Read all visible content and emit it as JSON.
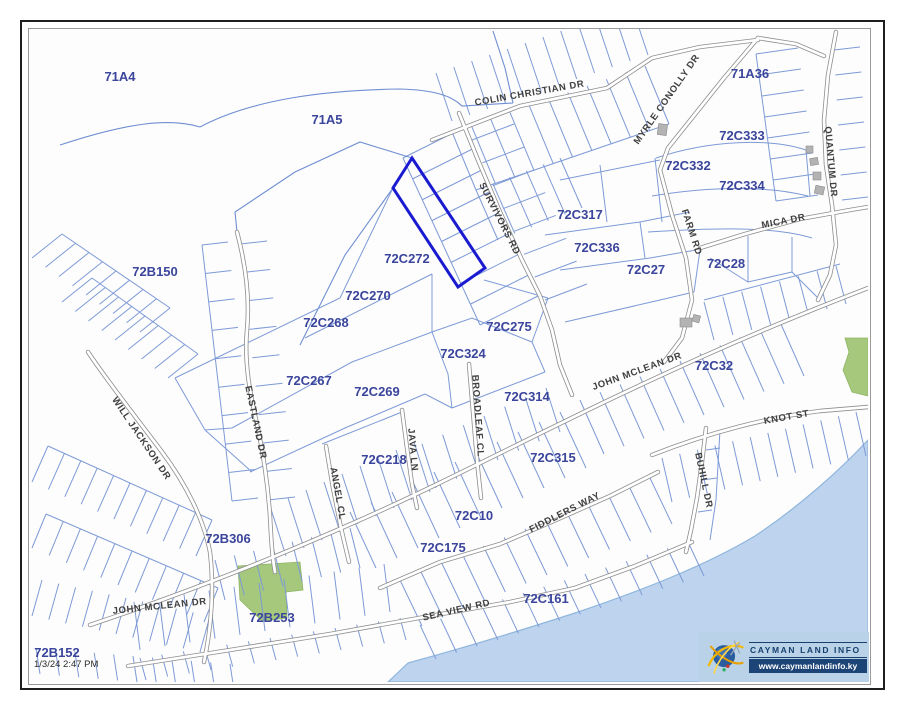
{
  "branding": {
    "name": "CAYMAN LAND INFO",
    "url": "www.caymanlandinfo.ky"
  },
  "status": {
    "timestamp": "1/3/24 2:47 PM"
  },
  "highlight": {
    "parcel_id": "72C272",
    "outline_color": "#1a1ad1"
  },
  "colors": {
    "parcel_line": "#7d9ad6",
    "road_casing": "#8d8d8d",
    "road_fill": "#ffffff",
    "parcel_label": "#3a459b",
    "road_label": "#3f3f3f",
    "water": "#bdd3ee",
    "vegetation": "#a5c87d",
    "building": "#b3b3b3",
    "logo_band": "#b9d2e8",
    "logo_navy": "#1c4476"
  },
  "map": {
    "parcel_labels": [
      {
        "text": "71A4",
        "x": 120,
        "y": 81
      },
      {
        "text": "71A5",
        "x": 327,
        "y": 124
      },
      {
        "text": "71A36",
        "x": 750,
        "y": 78
      },
      {
        "text": "72C333",
        "x": 742,
        "y": 140
      },
      {
        "text": "72C332",
        "x": 688,
        "y": 170
      },
      {
        "text": "72C334",
        "x": 742,
        "y": 190
      },
      {
        "text": "72C317",
        "x": 580,
        "y": 219
      },
      {
        "text": "72C336",
        "x": 597,
        "y": 252
      },
      {
        "text": "72C27",
        "x": 646,
        "y": 274
      },
      {
        "text": "72C28",
        "x": 726,
        "y": 268
      },
      {
        "text": "72B150",
        "x": 155,
        "y": 276
      },
      {
        "text": "72C272",
        "x": 407,
        "y": 263
      },
      {
        "text": "72C270",
        "x": 368,
        "y": 300
      },
      {
        "text": "72C268",
        "x": 326,
        "y": 327
      },
      {
        "text": "72C275",
        "x": 509,
        "y": 331
      },
      {
        "text": "72C324",
        "x": 463,
        "y": 358
      },
      {
        "text": "72C267",
        "x": 309,
        "y": 385
      },
      {
        "text": "72C269",
        "x": 377,
        "y": 396
      },
      {
        "text": "72C314",
        "x": 527,
        "y": 401
      },
      {
        "text": "72C32",
        "x": 714,
        "y": 370
      },
      {
        "text": "72C218",
        "x": 384,
        "y": 464
      },
      {
        "text": "72C315",
        "x": 553,
        "y": 462
      },
      {
        "text": "72C10",
        "x": 474,
        "y": 520
      },
      {
        "text": "72C175",
        "x": 443,
        "y": 552
      },
      {
        "text": "72B306",
        "x": 228,
        "y": 543
      },
      {
        "text": "72B253",
        "x": 272,
        "y": 622
      },
      {
        "text": "72C161",
        "x": 546,
        "y": 603
      },
      {
        "text": "72B152",
        "x": 57,
        "y": 657
      }
    ],
    "road_labels": [
      {
        "text": "COLIN CHRISTIAN DR",
        "x": 530,
        "y": 96,
        "angle": -10
      },
      {
        "text": "MYRLE CONOLLY DR",
        "x": 669,
        "y": 101,
        "angle": -55
      },
      {
        "text": "QUANTUM DR",
        "x": 828,
        "y": 162,
        "angle": 85
      },
      {
        "text": "SURVIVORS RD",
        "x": 497,
        "y": 220,
        "angle": 63
      },
      {
        "text": "FARM RD",
        "x": 689,
        "y": 233,
        "angle": 72
      },
      {
        "text": "MICA DR",
        "x": 784,
        "y": 224,
        "angle": -11
      },
      {
        "text": "JOHN MCLEAN DR",
        "x": 638,
        "y": 374,
        "angle": -20
      },
      {
        "text": "KNOT ST",
        "x": 787,
        "y": 420,
        "angle": -10
      },
      {
        "text": "BUHILL DR",
        "x": 701,
        "y": 481,
        "angle": 78
      },
      {
        "text": "FIDDLERS WAY",
        "x": 566,
        "y": 515,
        "angle": -27
      },
      {
        "text": "SEA VIEW RD",
        "x": 457,
        "y": 613,
        "angle": -13
      },
      {
        "text": "WILL JACKSON DR",
        "x": 139,
        "y": 440,
        "angle": 56
      },
      {
        "text": "EASTLAND DR",
        "x": 253,
        "y": 423,
        "angle": 78
      },
      {
        "text": "ANGEL CL",
        "x": 335,
        "y": 494,
        "angle": 80
      },
      {
        "text": "JAVA LN",
        "x": 410,
        "y": 450,
        "angle": 85
      },
      {
        "text": "BROADLEAF CL",
        "x": 475,
        "y": 416,
        "angle": 86
      },
      {
        "text": "JOHN MCLEAN DR",
        "x": 160,
        "y": 609,
        "angle": -6
      }
    ]
  }
}
